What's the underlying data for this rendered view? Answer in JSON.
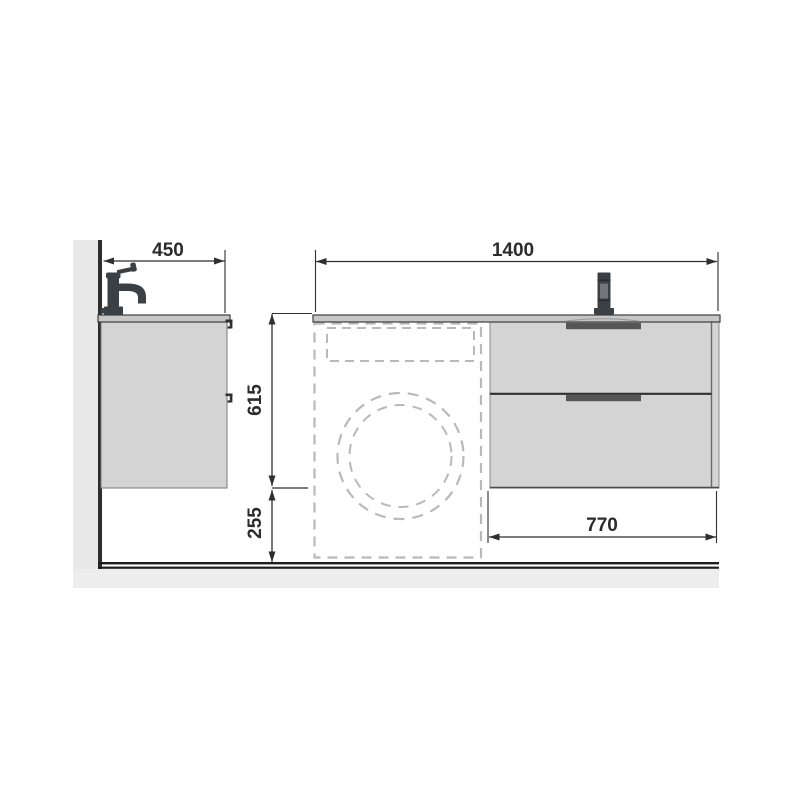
{
  "drawing": {
    "type": "technical-installation-diagram",
    "subject": "bathroom vanity unit with washing machine space, side view and front view",
    "dimensions": {
      "depth": "450",
      "total_width": "1400",
      "unit_height": "615",
      "clearance_height": "255",
      "drawer_unit_width": "770"
    },
    "views": {
      "side_view": [
        "wall",
        "countertop",
        "faucet",
        "cabinet with two drawer-handle profiles"
      ],
      "front_view": [
        "countertop",
        "faucet",
        "two-drawer cabinet with recessed handles",
        "dashed washing machine outline with drum circles"
      ]
    },
    "colors": {
      "cabinet_fill": "#d4d4d4",
      "countertop_fill": "#c7c7c7",
      "wall_fill": "#e8e8e8",
      "floor_fill": "#ededed",
      "outline_dark": "#2d2d2d",
      "handle_dark": "#565656",
      "dashed_gray": "#b9b9b9",
      "faucet_dark": "#3b4044",
      "dimension_text": "#2b2b2b"
    }
  }
}
